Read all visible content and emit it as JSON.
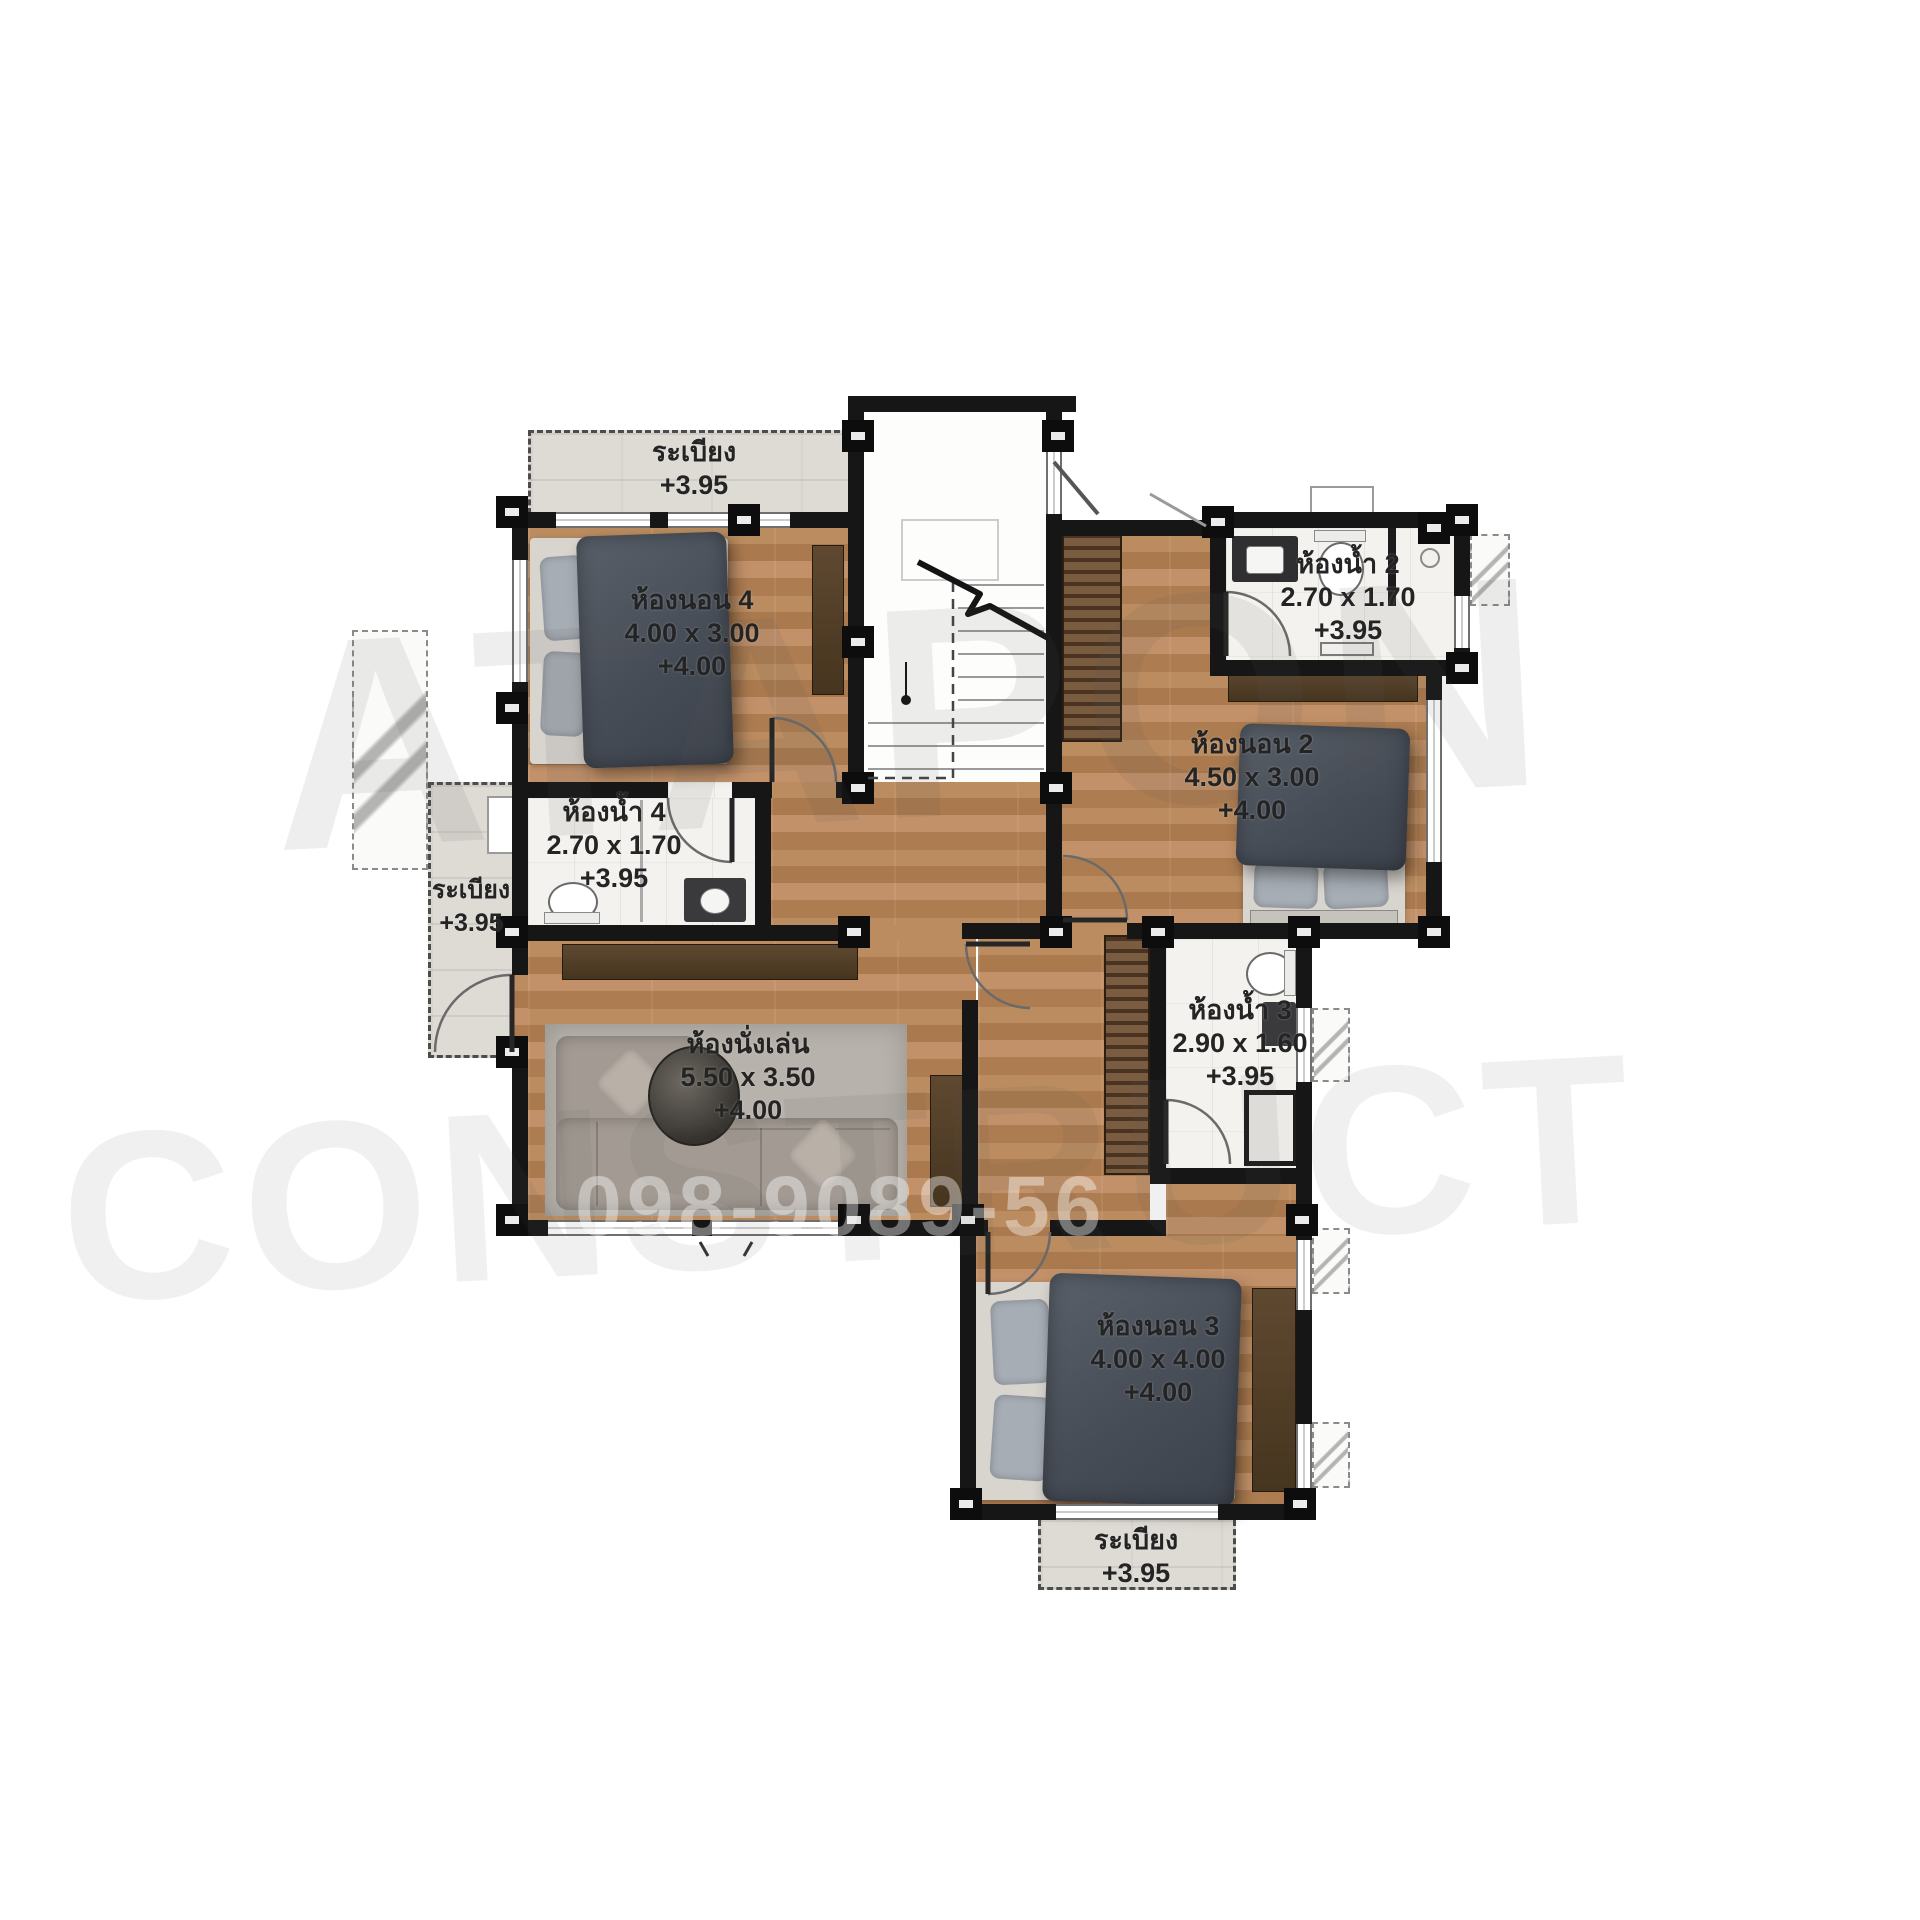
{
  "plan_title": "second-floor-plan",
  "rooms": {
    "balcony_top": {
      "name": "ระเบียง",
      "level": "+3.95"
    },
    "bedroom4": {
      "name": "ห้องนอน 4",
      "dims": "4.00 x 3.00",
      "level": "+4.00"
    },
    "bath2": {
      "name": "ห้องน้ำ 2",
      "dims": "2.70 x 1.70",
      "level": "+3.95"
    },
    "bedroom2": {
      "name": "ห้องนอน 2",
      "dims": "4.50 x 3.00",
      "level": "+4.00"
    },
    "bath4": {
      "name": "ห้องน้ำ 4",
      "dims": "2.70 x 1.70",
      "level": "+3.95"
    },
    "balcony_left": {
      "name": "ระเบียง",
      "level": "+3.95"
    },
    "living": {
      "name": "ห้องนั่งเล่น",
      "dims": "5.50 x 3.50",
      "level": "+4.00"
    },
    "bath3": {
      "name": "ห้องน้ำ 3",
      "dims": "2.90 x 1.60",
      "level": "+3.95"
    },
    "bedroom3": {
      "name": "ห้องนอน 3",
      "dims": "4.00 x 4.00",
      "level": "+4.00"
    },
    "balcony_bottom": {
      "name": "ระเบียง",
      "level": "+3.95"
    }
  },
  "watermark": {
    "brand": "ATAPON",
    "brand2": "CONSTRUCT",
    "phone": "098-9089-56"
  },
  "colors": {
    "wall": "#161616",
    "wood": "#b5875f",
    "tile_white": "#f3f2ef",
    "balcony_tile": "#dedbd5",
    "bed": "#4b505a"
  }
}
